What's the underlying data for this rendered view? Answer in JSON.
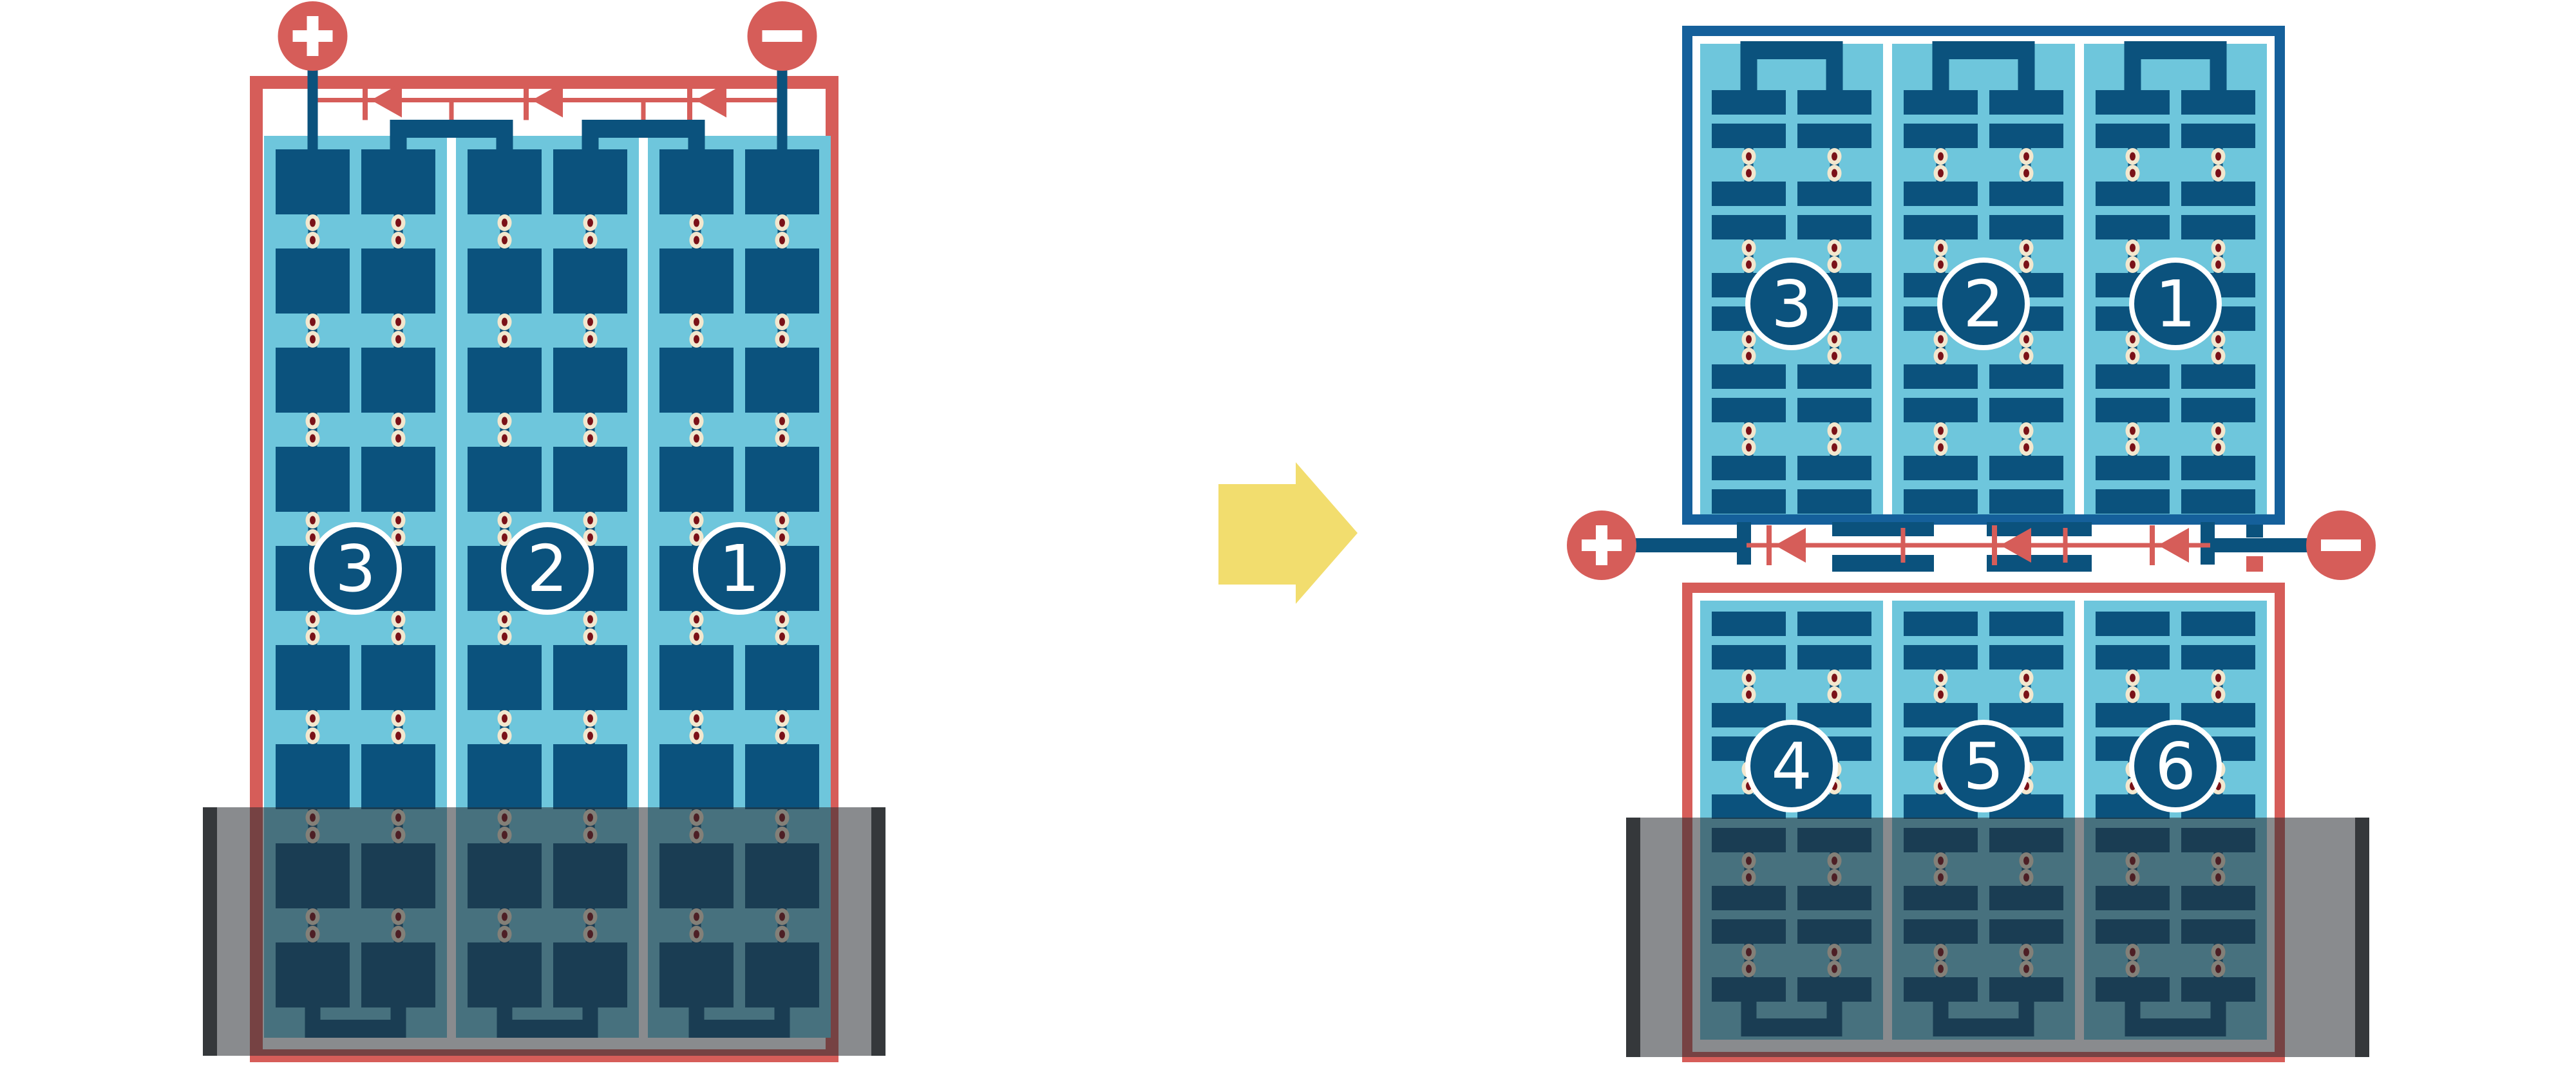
{
  "colors": {
    "red": "#D65D59",
    "blue": "#0B527D",
    "frame_blue": "#15609B",
    "light_blue": "#6EC6DC",
    "cream": "#F2E7CE",
    "dot_red": "#7A1118",
    "yellow": "#F2DD6E",
    "shade": "rgba(40,44,49,0.55)",
    "shade_bar": "#35383B",
    "white": "#FFFFFF"
  },
  "left_module": {
    "kind": "full-cell module, 3 series strings, lower part shaded",
    "strings": [
      {
        "label": "3"
      },
      {
        "label": "2"
      },
      {
        "label": "1"
      }
    ],
    "terminals": {
      "positive": "+",
      "negative": "−"
    },
    "bypass_diodes": 3
  },
  "right_module": {
    "kind": "half-cut-cell module, 6 half strings, centre junction, lower part shaded",
    "top_strings": [
      {
        "label": "3"
      },
      {
        "label": "2"
      },
      {
        "label": "1"
      }
    ],
    "bottom_strings": [
      {
        "label": "4"
      },
      {
        "label": "5"
      },
      {
        "label": "6"
      }
    ],
    "terminals": {
      "positive": "+",
      "negative": "−"
    },
    "bypass_diodes": 3
  },
  "transition": {
    "icon": "right-arrow"
  }
}
